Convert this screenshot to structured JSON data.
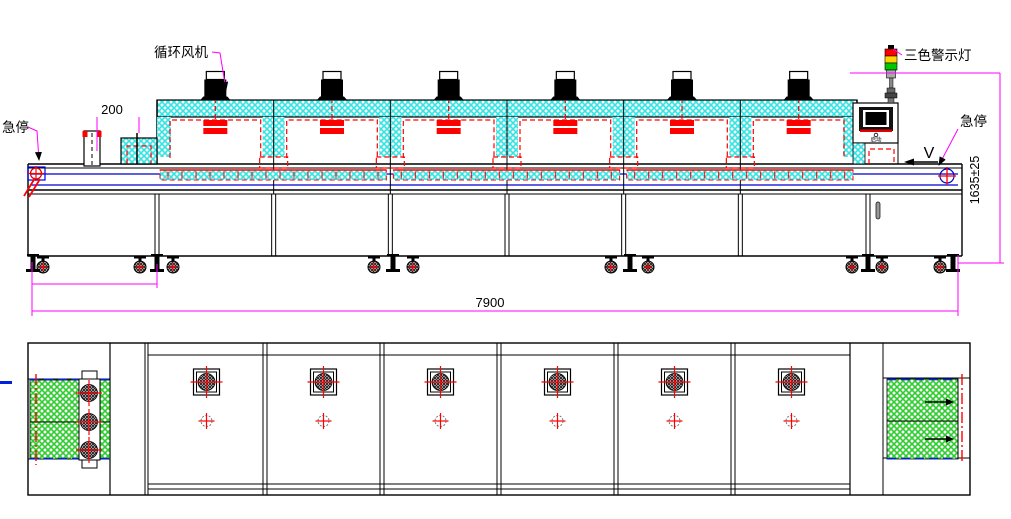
{
  "labels": {
    "circulation_fan": "循环风机",
    "three_color_warning_light": "三色警示灯",
    "emergency_stop_left": "急停",
    "emergency_stop_right": "急停",
    "start_button": "启动",
    "direction": "V"
  },
  "dimensions": {
    "infeed_to_oven": "200",
    "overall_length": "7900",
    "overall_height": "1635±25"
  },
  "machine": {
    "heating_chambers": 6,
    "circulation_fans": 6,
    "plan_sections": 6,
    "cooling_fans": 3,
    "oven_modules": 3,
    "exit_arrows": 2
  },
  "colors": {
    "insulation_hatch": "#35e3e3",
    "cooling_belt_hatch": "#2ecc2e",
    "heater_red": "#ff0000",
    "dimension_magenta": "#ff00ff",
    "belt_blue": "#0000cc",
    "light_red": "#ff0000",
    "light_yellow": "#ffd400",
    "light_green": "#00c800"
  }
}
